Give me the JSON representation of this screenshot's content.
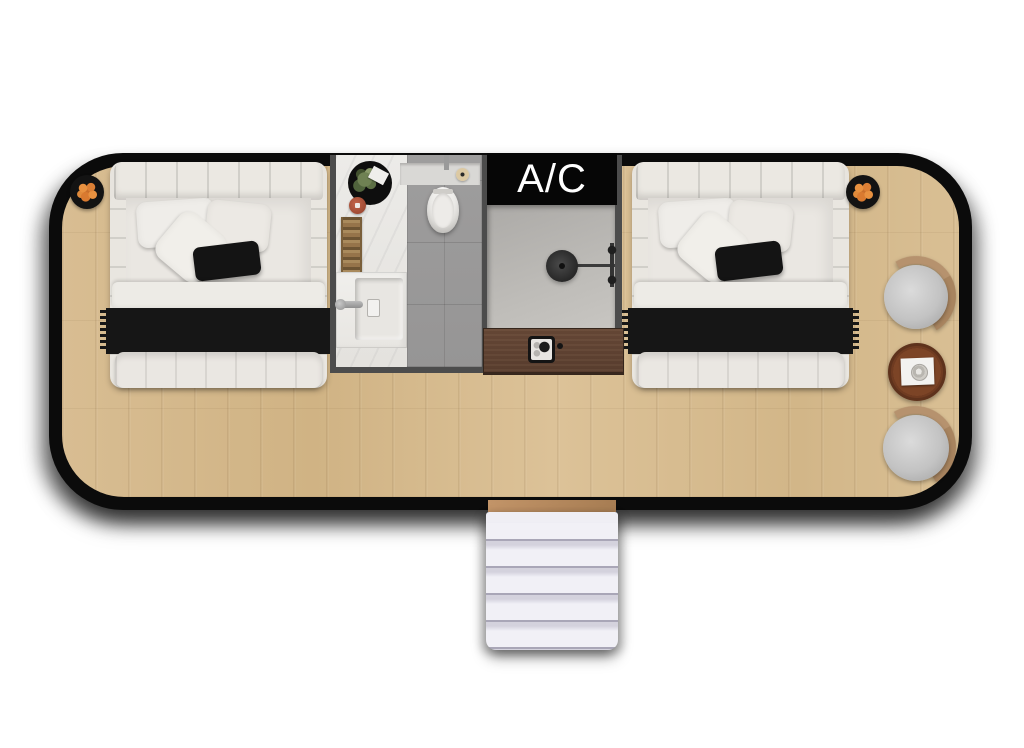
{
  "labels": {
    "ac": "A/C"
  },
  "colors": {
    "room_border": "#0b0b0b",
    "floor_wood": "#d6bb8f",
    "bathroom_marble": "#e9e7e3",
    "toilet_tile": "#9b9a9a",
    "shower_floor": "#b2b0ad",
    "interior_wall": "#4c4c4c",
    "cabinet_wood": "#5e4333",
    "bed_linen": "#e9e6e1",
    "throw_blanket": "#161616",
    "fruit_accent": "#e0873a",
    "chair_seat": "#c6c6c6",
    "chair_back_wood": "#b2906c",
    "side_table_wood": "#80452a",
    "stairs": "#ecebf1",
    "stair_landing": "#b5895d"
  },
  "scene": {
    "type": "floor-plan-top-view",
    "rooms": [
      {
        "name": "bedroom",
        "floor": "light-wood-planks"
      },
      {
        "name": "bathroom",
        "floor": "marble-and-gray-tile",
        "fixtures": [
          "toilet",
          "toilet-paper-roll",
          "sink-counter",
          "faucet",
          "towel-ladder",
          "plant-rug",
          "terracotta-stool"
        ]
      },
      {
        "name": "shower-room",
        "fixtures": [
          "rain-shower-head",
          "shower-arm",
          "shower-valves"
        ]
      },
      {
        "name": "ac-closet",
        "label": "A/C"
      }
    ],
    "furniture": [
      "double-bed-left",
      "double-bed-right",
      "fruit-plate-left",
      "fruit-plate-right",
      "console-cabinet",
      "portable-stove",
      "lounge-chair-top",
      "lounge-chair-bottom",
      "round-side-table",
      "serving-tray",
      "cup",
      "entry-stairs"
    ]
  }
}
